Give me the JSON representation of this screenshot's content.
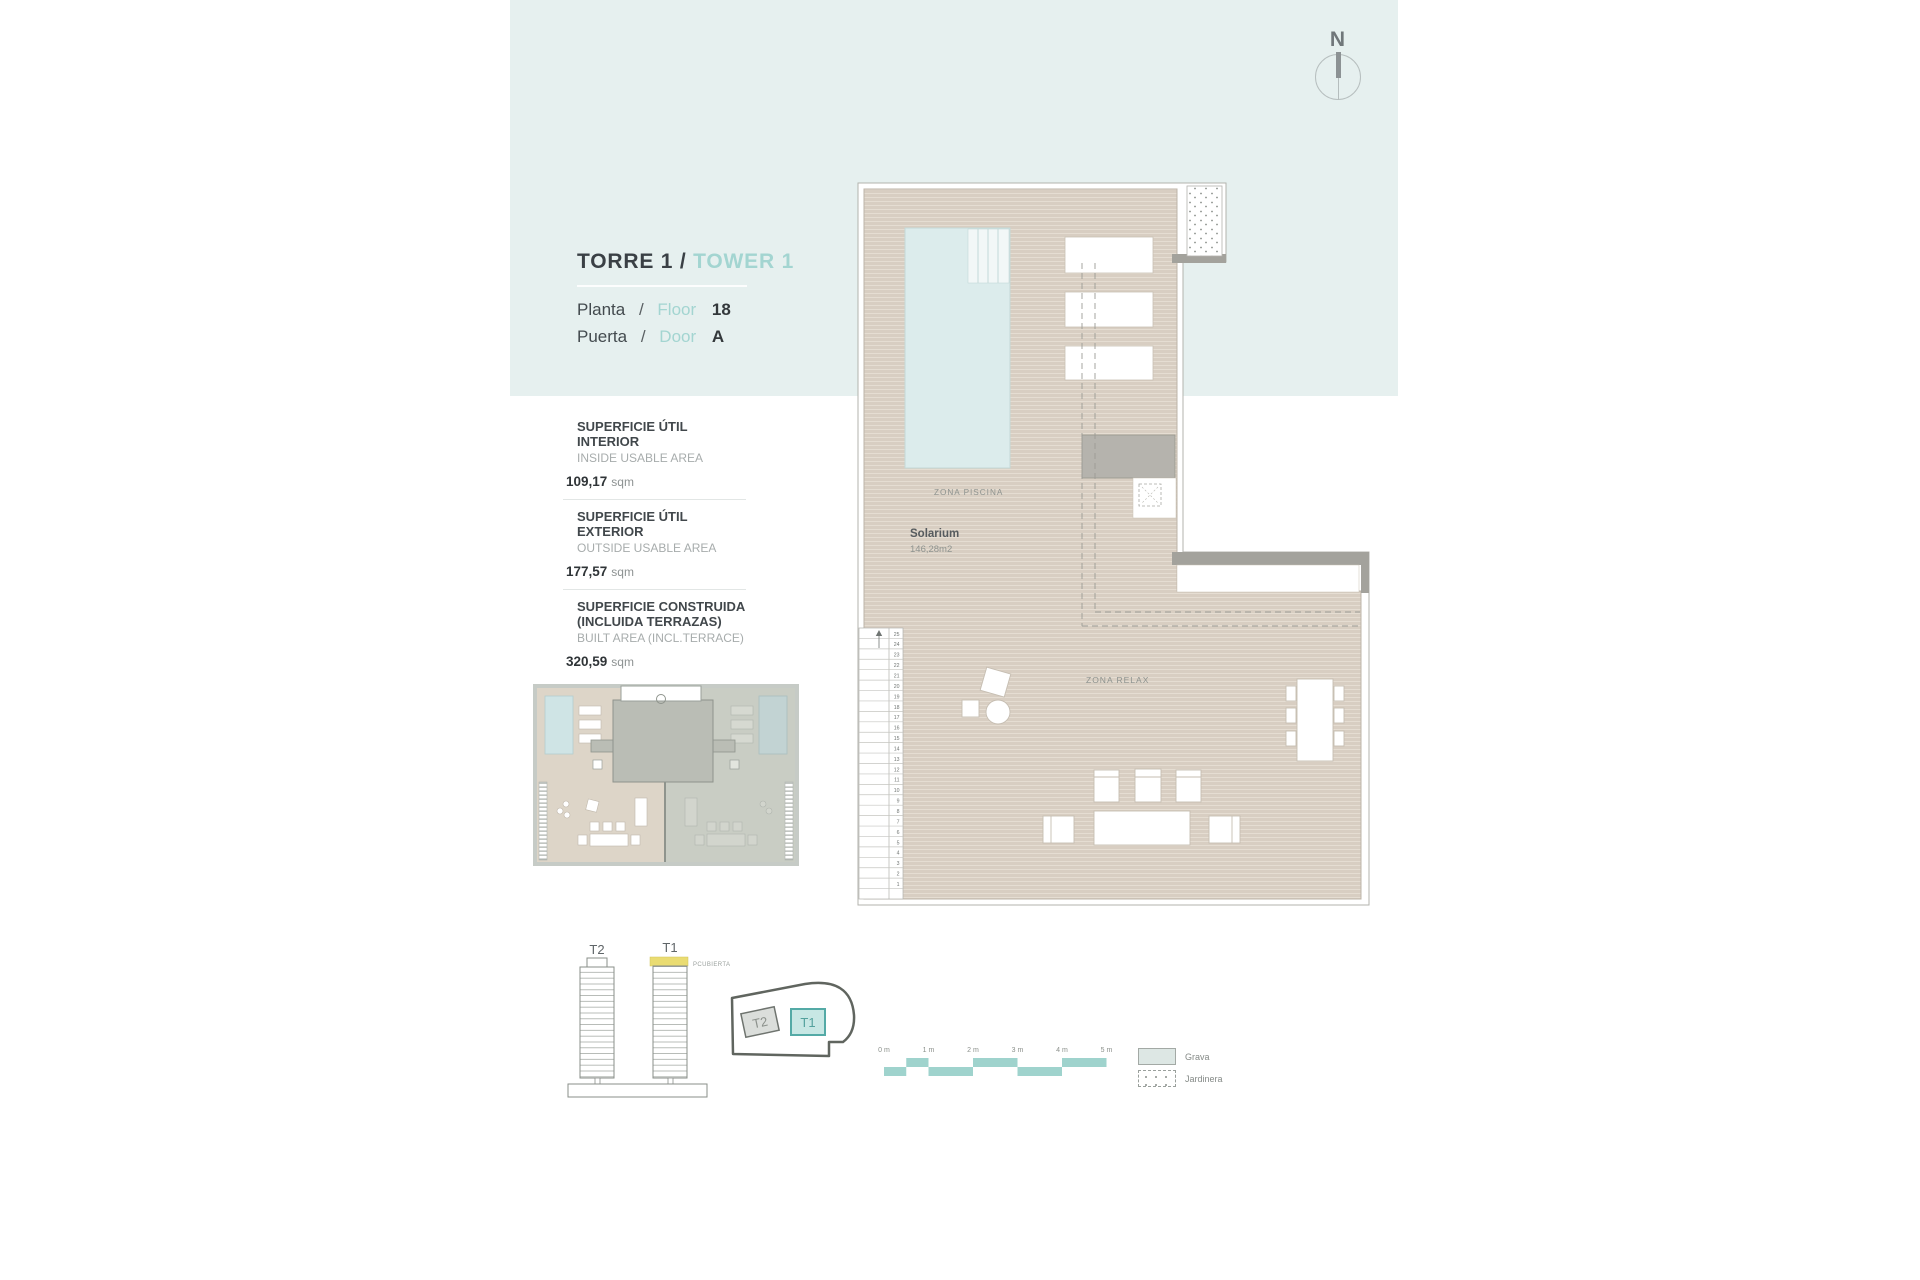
{
  "header": {
    "title_es": "TORRE 1 /",
    "title_en": "TOWER 1",
    "floor_label_es": "Planta",
    "floor_label_en": "Floor",
    "floor_value": "18",
    "door_label_es": "Puerta",
    "door_label_en": "Door",
    "door_value": "A",
    "separator": "/"
  },
  "compass": {
    "north_label": "N"
  },
  "areas": [
    {
      "es": "SUPERFICIE ÚTIL INTERIOR",
      "es2": "",
      "en": "INSIDE USABLE AREA",
      "value": "109,17",
      "unit": "sqm"
    },
    {
      "es": "SUPERFICIE ÚTIL EXTERIOR",
      "es2": "",
      "en": "OUTSIDE USABLE AREA",
      "value": "177,57",
      "unit": "sqm"
    },
    {
      "es": "SUPERFICIE CONSTRUIDA",
      "es2": "(INCLUIDA TERRAZAS)",
      "en": "BUILT AREA (INCL.TERRACE)",
      "value": "320,59",
      "unit": "sqm"
    }
  ],
  "plan": {
    "zona_piscina": "ZONA PISCINA",
    "solarium_label": "Solarium",
    "solarium_area": "146,28m2",
    "zona_relax": "ZONA RELAX",
    "stair_numbers": [
      "25",
      "24",
      "23",
      "22",
      "21",
      "20",
      "19",
      "18",
      "17",
      "16",
      "15",
      "14",
      "13",
      "12",
      "11",
      "10",
      "9",
      "8",
      "7",
      "6",
      "5",
      "4",
      "3",
      "2",
      "1"
    ]
  },
  "towers": {
    "t2_label": "T2",
    "t1_label": "T1",
    "roof_label": "PCUBIERTA"
  },
  "site": {
    "t2_label": "T2",
    "t1_label": "T1"
  },
  "scalebar": {
    "labels": [
      "0 m",
      "1 m",
      "2 m",
      "3 m",
      "4 m",
      "5 m"
    ]
  },
  "legend": [
    {
      "label": "Grava"
    },
    {
      "label": "Jardinera"
    }
  ],
  "colors": {
    "band_blue": "#e6f0ef",
    "accent_teal": "#a3d5d1",
    "deck_beige": "#d8cec2",
    "pool_blue": "#dcecec",
    "scalebar_teal": "#9fd3cd",
    "roof_highlight_yellow": "#eadc72",
    "t1_fill": "#c7e7e4",
    "t1_border": "#54aaa6",
    "wall_gray": "#a3a29c"
  }
}
